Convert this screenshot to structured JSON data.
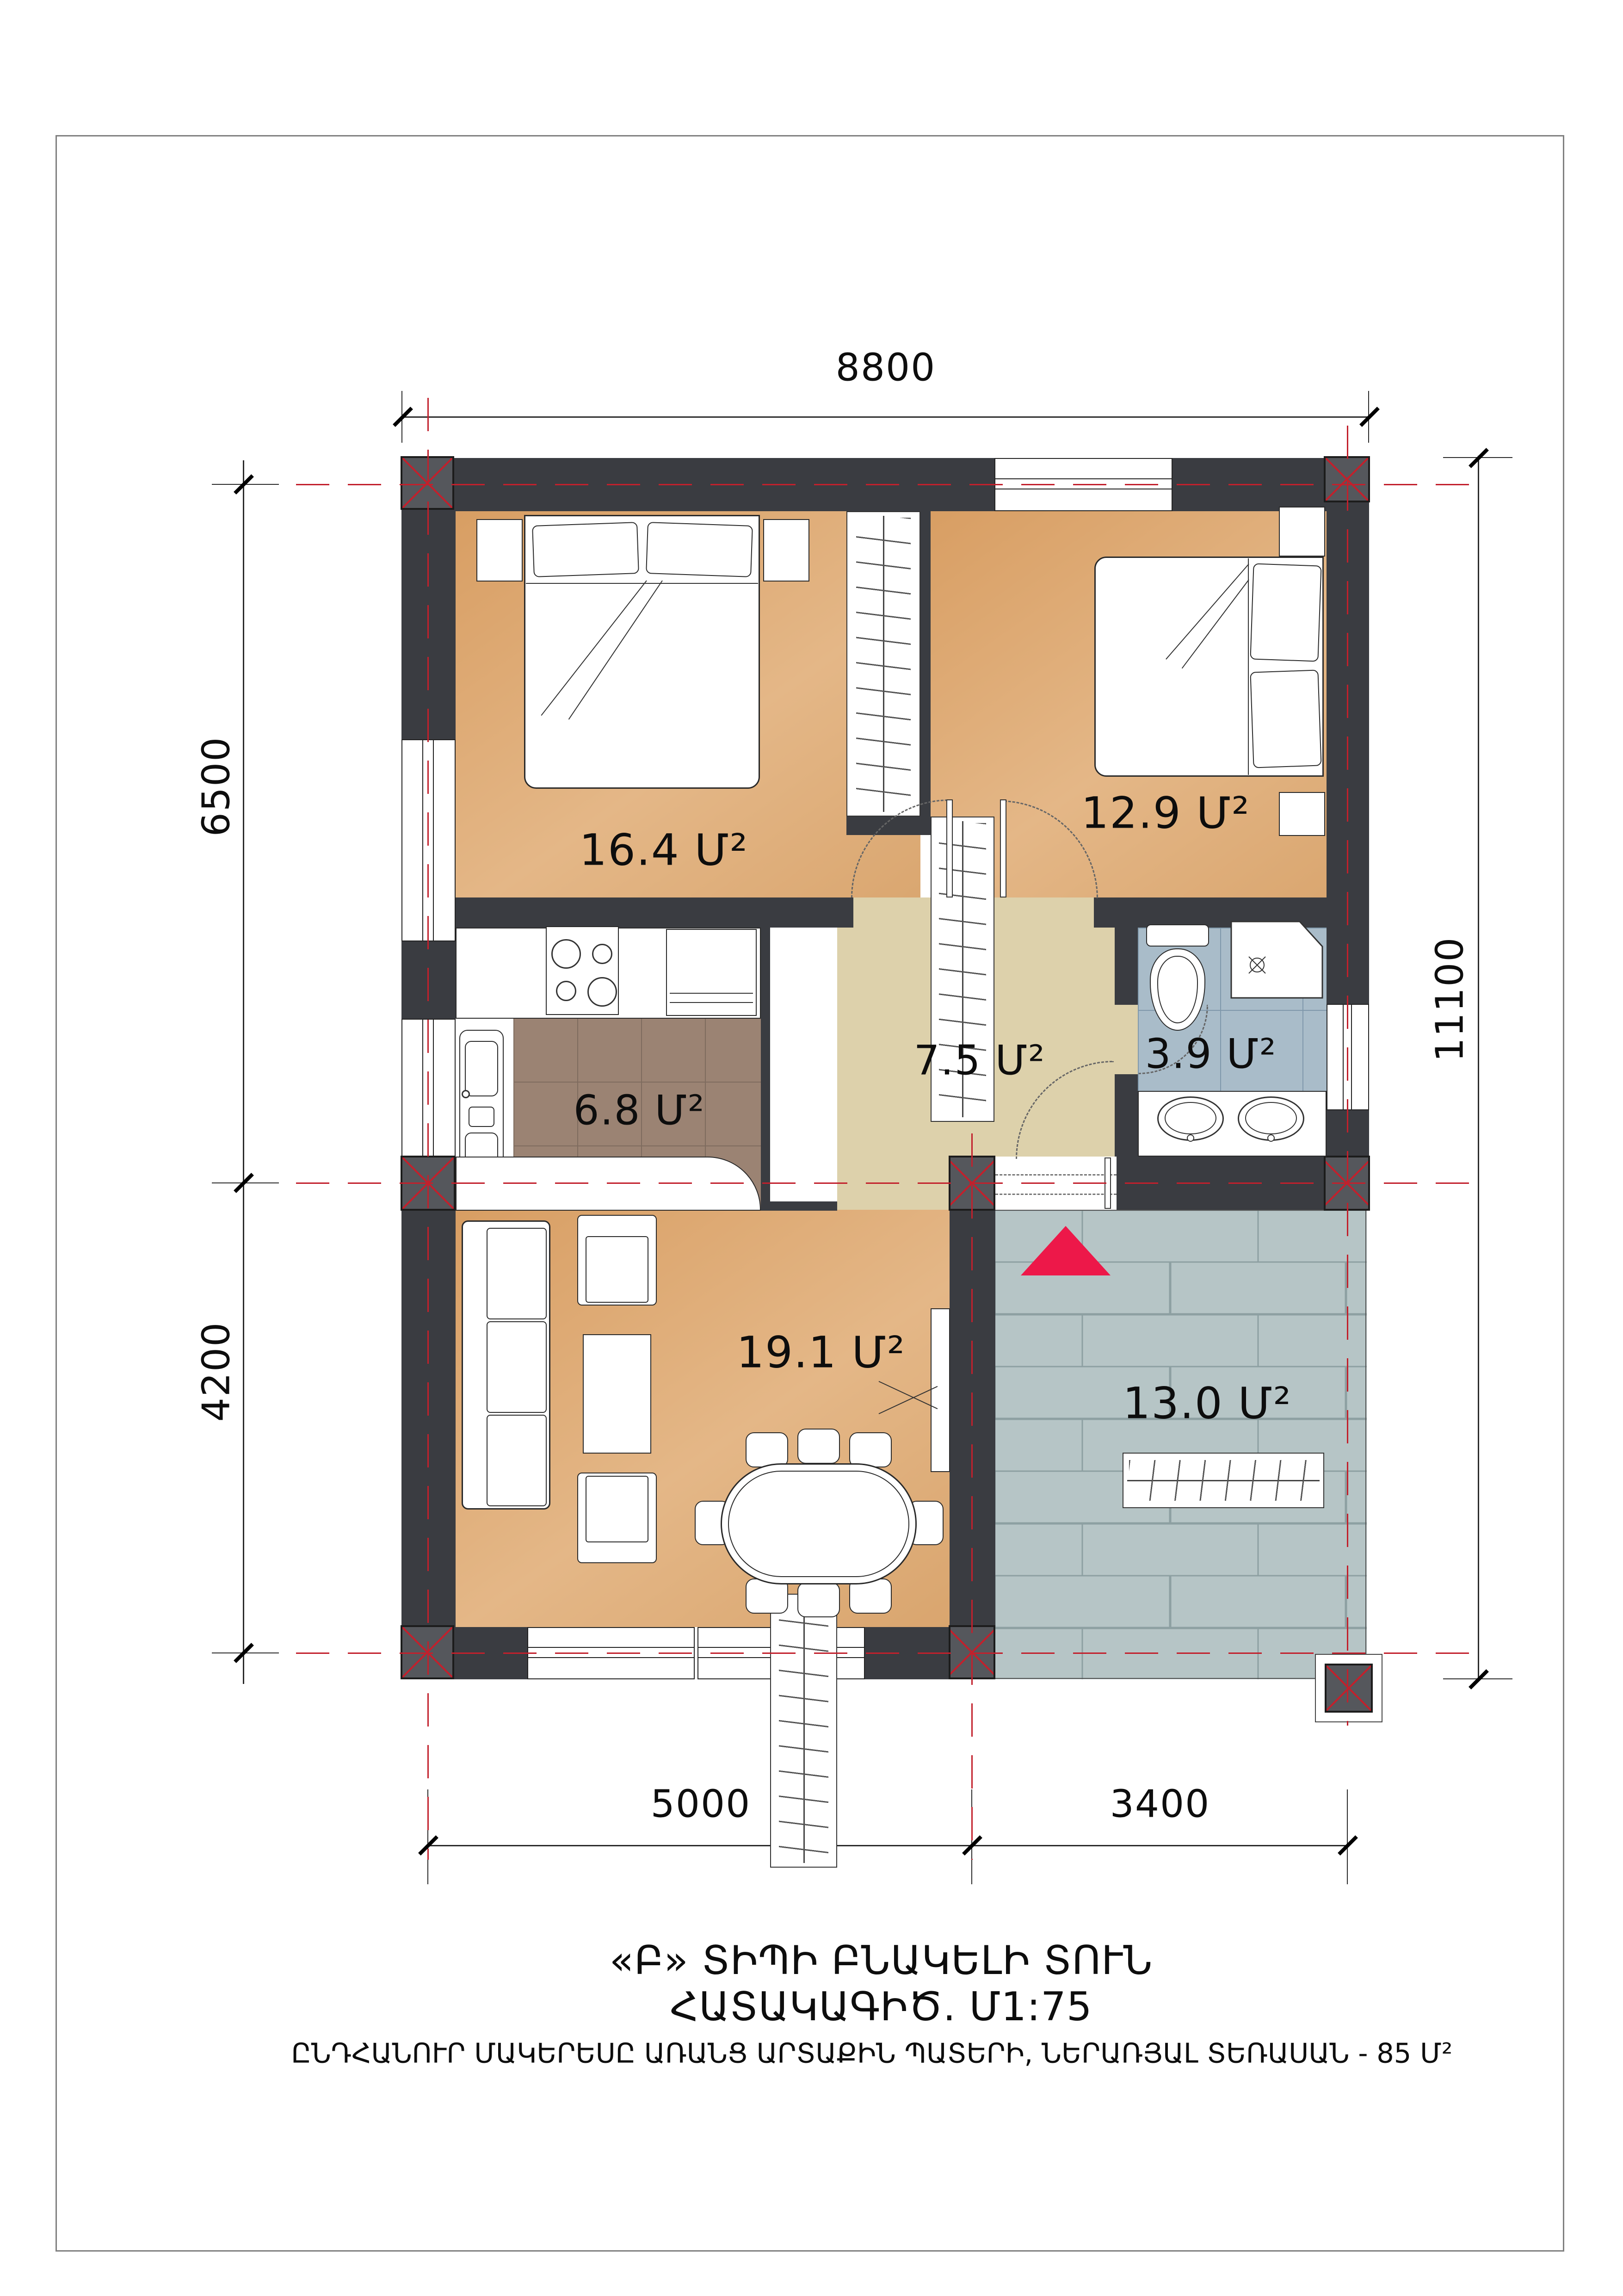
{
  "dimensions": {
    "top": "8800",
    "left_upper": "6500",
    "left_lower": "4200",
    "right": "11100",
    "bottom_left": "5000",
    "bottom_right": "3400"
  },
  "rooms": [
    {
      "id": "bedroom-1",
      "area_label": "16.4 Մ²"
    },
    {
      "id": "bedroom-2",
      "area_label": "12.9 Մ²"
    },
    {
      "id": "kitchen",
      "area_label": "6.8 Մ²"
    },
    {
      "id": "hallway",
      "area_label": "7.5 Մ²"
    },
    {
      "id": "bathroom",
      "area_label": "3.9 Մ²"
    },
    {
      "id": "living-room",
      "area_label": "19.1 Մ²"
    },
    {
      "id": "terrace",
      "area_label": "13.0 Մ²"
    }
  ],
  "title_block": {
    "line1": "«Բ»  ՏԻՊԻ ԲՆԱԿԵԼԻ ՏՈՒՆ",
    "line2": "ՀԱՏԱԿԱԳԻԾ.  Մ1:75",
    "line3": "ԸՆԴՀԱՆՈՒՐ ՄԱԿԵՐԵՍԸ ԱՌԱՆՑ ԱՐՏԱՔԻՆ ՊԱՏԵՐԻ, ՆԵՐԱՌՅԱԼ ՏԵՌԱՍԱՆ - 85 Մ²"
  },
  "colors": {
    "wall": "#3a3c41",
    "column": "#55575c",
    "axis_red": "#c2202c",
    "room_floor": "#d9a56e",
    "hall_floor": "#ddd1ab",
    "kitchen_tile": "#9b8373",
    "bath_tile": "#a9bcc9",
    "terrace_paver": "#b6c5c6",
    "entrance_marker": "#ed1849"
  }
}
